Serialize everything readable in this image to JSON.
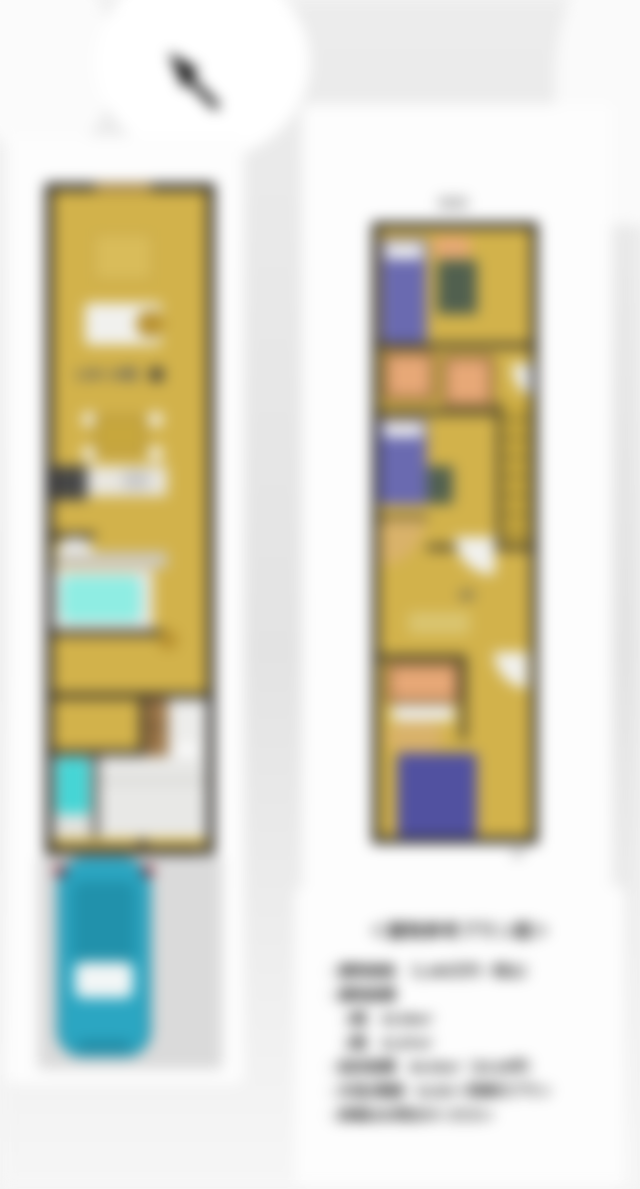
{
  "floor1": {
    "label": "1F",
    "room_label": "LDK 16帖"
  },
  "floor2": {
    "label": "2F"
  },
  "info_card": {
    "title": "＜建物参考プラン図＞",
    "lines": [
      "□建物価格　（1,485万円・税込）",
      "□建物面積",
      "　1階　43.06m²",
      "　2階　41.87m²",
      "□延床面積　84.93m²（25.69坪）",
      "□木造2階建・3LDK＋車庫付プラン",
      "□詳細はお問合せください"
    ]
  },
  "colors": {
    "paper": "#fdfdfd",
    "floor": "#d2b24b",
    "wall": "#2d2a26",
    "bed": "#6a6ab0",
    "bed_dark": "#5151a0",
    "tub": "#8fede3",
    "shower": "#45d5d5",
    "car": "#2ba6c2",
    "car_dark": "#2191ab",
    "orange": "#e7a877",
    "orange_dark": "#5d3d29",
    "tan": "#d9b26a",
    "green_desk": "#51604f",
    "gold": "#b8912f",
    "counter": "#e9e7e1",
    "white_soft": "#f1f1ee"
  }
}
